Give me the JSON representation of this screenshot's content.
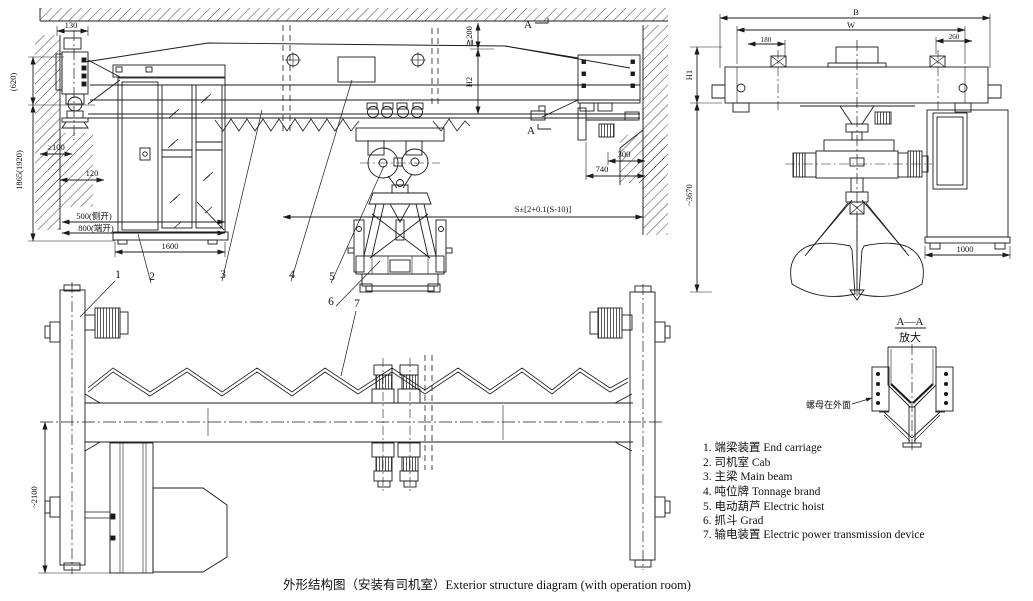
{
  "caption": "外形结构图（安装有司机室）Exterior structure diagram (with operation room)",
  "legend": {
    "items": [
      {
        "label": "1. 端梁装置  End carriage"
      },
      {
        "label": "2. 司机室  Cab"
      },
      {
        "label": "3. 主梁  Main beam"
      },
      {
        "label": "4. 吨位牌  Tonnage brand"
      },
      {
        "label": "5. 电动葫芦  Electric hoist"
      },
      {
        "label": "6. 抓斗  Grad"
      },
      {
        "label": "7. 输电装置  Electric power transmission device"
      }
    ]
  },
  "detail_view": {
    "title": "A—A",
    "subtitle": "放大",
    "note": "螺母在外面"
  },
  "section_marks": {
    "label": "A"
  },
  "callouts": {
    "c1": "1",
    "c2": "2",
    "c3": "3",
    "c4": "4",
    "c5": "5",
    "c6": "6",
    "c7": "7"
  },
  "dims": {
    "elevation": {
      "d130": "130",
      "d620": "(620)",
      "d_ge100": "≥100",
      "d1865": "1865(1920)",
      "d120": "120",
      "d500": "500(侧开)",
      "d800": "800(端开)",
      "d1600": "1600",
      "d_ge200": "≧200",
      "h2": "H2",
      "d300": "300",
      "d740": "740",
      "span": "S±[2+0.1(S-10)]"
    },
    "plan": {
      "d2100": "~2100"
    },
    "end_view": {
      "b": "B",
      "w": "W",
      "d180": "180",
      "d260": "260",
      "h1": "H1",
      "d3670": "~3670",
      "d1000": "1000"
    }
  },
  "colors": {
    "line": "#1b1b1b",
    "bg": "#ffffff"
  }
}
